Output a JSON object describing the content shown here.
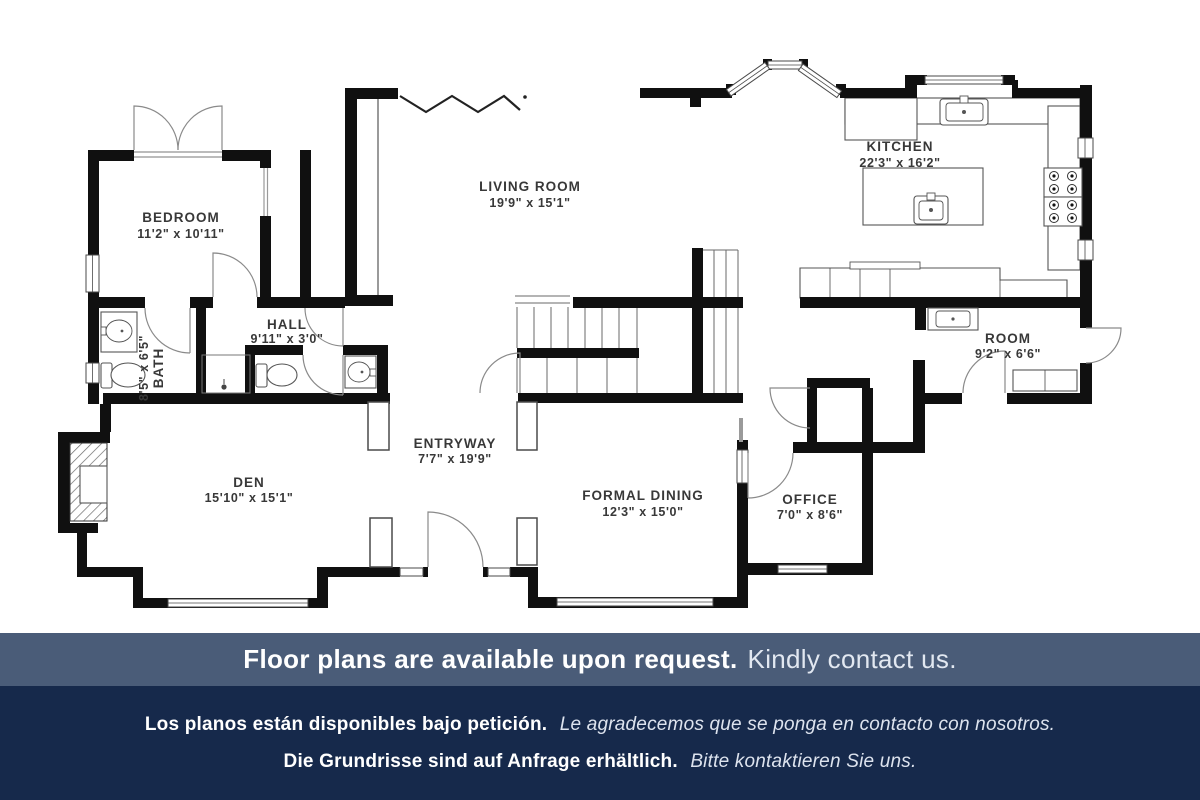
{
  "plan": {
    "rooms": [
      {
        "name": "BEDROOM",
        "dims": "11'2\" x 10'11\""
      },
      {
        "name": "LIVING ROOM",
        "dims": "19'9\" x 15'1\""
      },
      {
        "name": "KITCHEN",
        "dims": "22'3\" x 16'2\""
      },
      {
        "name": "HALL",
        "dims": "9'11\" x 3'0\""
      },
      {
        "name": "BATH",
        "dims": "8'5\" x 6'5\""
      },
      {
        "name": "DEN",
        "dims": "15'10\" x 15'1\""
      },
      {
        "name": "ENTRYWAY",
        "dims": "7'7\" x 19'9\""
      },
      {
        "name": "FORMAL DINING",
        "dims": "12'3\" x 15'0\""
      },
      {
        "name": "OFFICE",
        "dims": "7'0\" x 8'6\""
      },
      {
        "name": "ROOM",
        "dims": "9'2\" x 6'6\""
      }
    ]
  },
  "banner": {
    "en": {
      "bold": "Floor plans are available upon request.",
      "regular": "Kindly contact us."
    },
    "es": {
      "bold": "Los planos están disponibles bajo petición.",
      "italic": "Le agradecemos que se ponga en contacto con nosotros."
    },
    "de": {
      "bold": "Die Grundrisse sind auf Anfrage erhältlich.",
      "italic": "Bitte kontaktieren Sie uns."
    }
  },
  "colors": {
    "walls": "#101010",
    "band_top_bg": "#4a5c78",
    "band_bottom_bg": "#16294b",
    "text_light": "#ffffff"
  }
}
